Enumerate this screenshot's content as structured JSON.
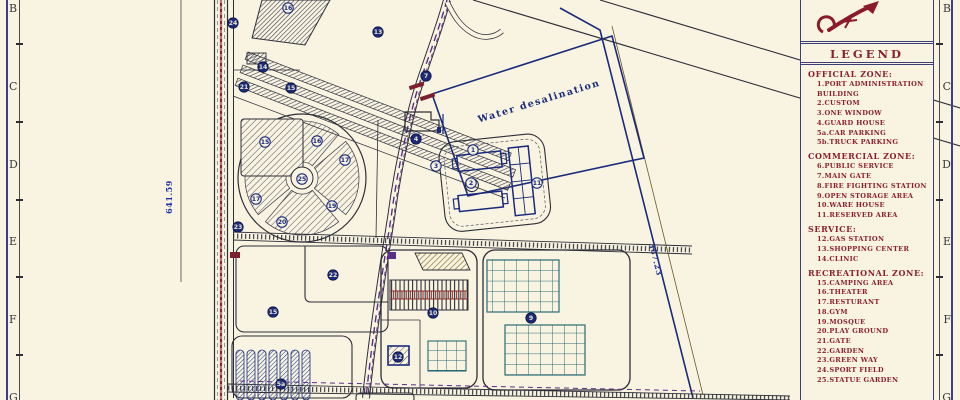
{
  "sheet": {
    "background": "#f8f4e1",
    "row_labels": [
      "B",
      "C",
      "D",
      "E",
      "F",
      "G"
    ]
  },
  "colors": {
    "paper": "#f8f4e1",
    "line_dark": "#2e2e38",
    "line_navy": "#1b2a7b",
    "legend_red": "#8c1f2e",
    "panel_border": "#3d3d7a",
    "road_center_purple": "#5b2f86",
    "road_center_maroon": "#7c2a3a",
    "grid_teal": "#2a6b75",
    "hatch_gold": "#8a7631",
    "dim_blue": "#2233a8"
  },
  "plan": {
    "water_label": "Water desalination",
    "dim_left": "641.59",
    "dim_right": "367.23",
    "markers": [
      {
        "n": "24",
        "x": 233,
        "y": 23,
        "f": 1
      },
      {
        "n": "16",
        "x": 288,
        "y": 8,
        "f": 0
      },
      {
        "n": "13",
        "x": 378,
        "y": 32,
        "f": 1
      },
      {
        "n": "7",
        "x": 426,
        "y": 76,
        "f": 1
      },
      {
        "n": "14",
        "x": 263,
        "y": 67,
        "f": 1
      },
      {
        "n": "21",
        "x": 244,
        "y": 87,
        "f": 1
      },
      {
        "n": "15",
        "x": 291,
        "y": 88,
        "f": 1
      },
      {
        "n": "15",
        "x": 265,
        "y": 142,
        "f": 0
      },
      {
        "n": "16",
        "x": 317,
        "y": 141,
        "f": 0
      },
      {
        "n": "17",
        "x": 345,
        "y": 160,
        "f": 0
      },
      {
        "n": "25",
        "x": 302,
        "y": 179,
        "f": 0
      },
      {
        "n": "17",
        "x": 256,
        "y": 199,
        "f": 0
      },
      {
        "n": "19",
        "x": 332,
        "y": 206,
        "f": 0
      },
      {
        "n": "20",
        "x": 282,
        "y": 222,
        "f": 0
      },
      {
        "n": "23",
        "x": 238,
        "y": 227,
        "f": 1
      },
      {
        "n": "4",
        "x": 416,
        "y": 139,
        "f": 1
      },
      {
        "n": "3",
        "x": 436,
        "y": 166,
        "f": 0
      },
      {
        "n": "1",
        "x": 473,
        "y": 150,
        "f": 0
      },
      {
        "n": "2",
        "x": 471,
        "y": 183,
        "f": 0
      },
      {
        "n": "11",
        "x": 537,
        "y": 183,
        "f": 0
      },
      {
        "n": "22",
        "x": 333,
        "y": 275,
        "f": 1
      },
      {
        "n": "15",
        "x": 273,
        "y": 312,
        "f": 1
      },
      {
        "n": "10",
        "x": 433,
        "y": 313,
        "f": 1
      },
      {
        "n": "9",
        "x": 531,
        "y": 318,
        "f": 1
      },
      {
        "n": "12",
        "x": 398,
        "y": 357,
        "f": 1
      },
      {
        "n": "5a",
        "x": 281,
        "y": 384,
        "f": 1
      }
    ]
  },
  "legend": {
    "title": "LEGEND",
    "sections": [
      {
        "heading": "OFFICIAL  ZONE:",
        "items": [
          "1.PORT ADMINISTRATION BUILDING",
          "2.CUSTOM",
          "3.ONE WINDOW",
          "4.GUARD HOUSE",
          "5a.CAR PARKING",
          "5b.TRUCK PARKING"
        ]
      },
      {
        "heading": "COMMERCIAL  ZONE:",
        "items": [
          "6.PUBLIC SERVICE",
          "7.MAIN GATE",
          "8.FIRE FIGHTING STATION",
          "9.OPEN STORAGE AREA",
          "10.WARE HOUSE",
          "11.RESERVED AREA"
        ]
      },
      {
        "heading": "SERVICE:",
        "items": [
          "12.GAS STATION",
          "13.SHOPPING CENTER",
          "14.CLINIC"
        ]
      },
      {
        "heading": "RECREATIONAL  ZONE:",
        "items": [
          "15.CAMPING AREA",
          "16.THEATER",
          "17.RESTURANT",
          "18.GYM",
          "19.MOSQUE",
          "20.PLAY GROUND",
          "21.GATE",
          "22.GARDEN",
          "23.GREEN WAY",
          "24.SPORT FIELD",
          "25.STATUE GARDEN"
        ]
      }
    ]
  }
}
